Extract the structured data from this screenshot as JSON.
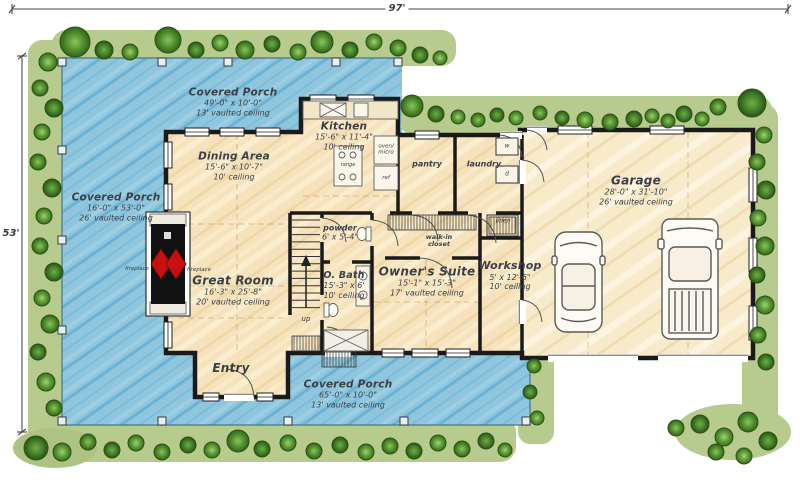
{
  "plan": {
    "overall_width": "97'",
    "overall_height": "53'"
  },
  "rooms": {
    "porch_top": {
      "name": "Covered Porch",
      "size": "49'-0\" x 10'-0\"",
      "ceiling": "13' vaulted ceiling"
    },
    "porch_left": {
      "name": "Covered Porch",
      "size": "16'-0\" x 53'-0\"",
      "ceiling": "26' vaulted ceiling"
    },
    "porch_bottom": {
      "name": "Covered Porch",
      "size": "65'-0\" x 10'-0\"",
      "ceiling": "13' vaulted ceiling"
    },
    "dining": {
      "name": "Dining Area",
      "size": "15'-6\" x 10'-7\"",
      "ceiling": "10' ceiling"
    },
    "kitchen": {
      "name": "Kitchen",
      "size": "15'-6\" x 11'-4\"",
      "ceiling": "10' ceiling"
    },
    "great_room": {
      "name": "Great Room",
      "size": "16'-3\" x 25'-8\"",
      "ceiling": "20' vaulted ceiling"
    },
    "entry": {
      "name": "Entry"
    },
    "powder": {
      "name": "powder",
      "size": "6' x 5'-4\""
    },
    "bath": {
      "name": "O. Bath",
      "size": "15'-3\" x 6'",
      "ceiling": "10' ceiling"
    },
    "owners_suite": {
      "name": "Owner's Suite",
      "size": "15'-1\" x 15'-3\"",
      "ceiling": "17' vaulted ceiling"
    },
    "closet": {
      "name": "walk-in closet"
    },
    "pantry": {
      "name": "pantry"
    },
    "laundry": {
      "name": "laundry"
    },
    "linen": {
      "name": "linen"
    },
    "workshop": {
      "name": "Workshop",
      "size": "5' x 12'-6\"",
      "ceiling": "10' ceiling"
    },
    "garage": {
      "name": "Garage",
      "size": "28'-0\" x 31'-10\"",
      "ceiling": "26' vaulted ceiling"
    }
  },
  "annotations": {
    "fireplace_porch": "fireplace",
    "fireplace_room": "fireplace",
    "oven_micro": "oven/ micro",
    "ref": "ref",
    "range": "range",
    "stairs_up": "up",
    "washer": "w",
    "dryer": "d"
  },
  "colors": {
    "porch": "#8fc6dd",
    "porch_stroke": "#5fa8c8",
    "floor": "#f6e3bd",
    "garage_floor": "#f8ebcb",
    "grass": "#b7cb8e",
    "tree": "#4e8f2d",
    "wall": "#1a1a1a",
    "fireplace_flame": "#c81010"
  }
}
